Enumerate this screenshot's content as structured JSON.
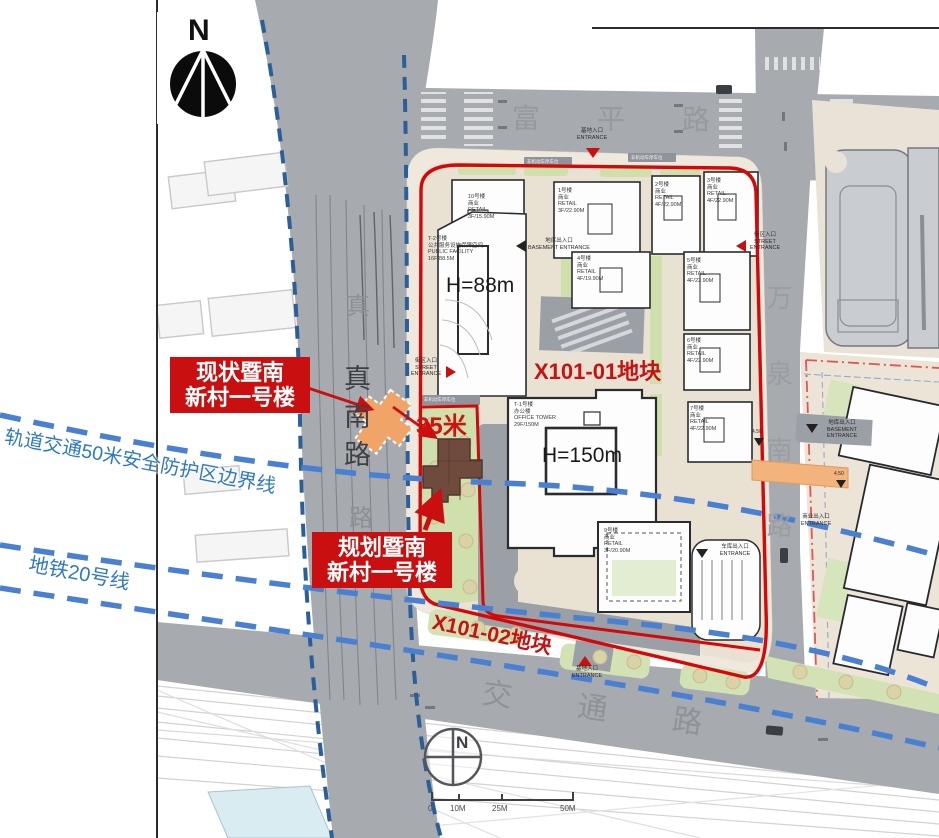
{
  "compass": {
    "north_label": "N",
    "south_compass_label": "N"
  },
  "roads": {
    "north": "富平路",
    "west": "真南路",
    "west_faint_top": "真",
    "west_faint_bottom": "路",
    "south": "交通路",
    "east": "万泉南路"
  },
  "parcels": {
    "p1": "X101-01地块",
    "p2": "X101-02地块"
  },
  "heights": {
    "west_tower": "H=88m",
    "center_tower": "H=150m"
  },
  "callouts": {
    "existing": {
      "line1": "现状暨南",
      "line2": "新村一号楼"
    },
    "planned": {
      "line1": "规划暨南",
      "line2": "新村一号楼"
    },
    "distance": "35米"
  },
  "transit": {
    "protection": "轨道交通50米安全防护区边界线",
    "metro": "地铁20号线"
  },
  "entrances": {
    "north_cn": "基地入口",
    "north_en": "ENTRANCE",
    "west_cn": "街区入口",
    "west_en": "STREET ENTRANCE",
    "east_cn": "街区入口",
    "east_en": "STREET ENTRANCE",
    "south_cn": "基地入口",
    "south_en": "ENTRANCE",
    "basement_cn": "地库出入口",
    "basement_en": "BASEMENT ENTRANCE",
    "garage_cn": "车库出入口",
    "garage_en": "ENTRANCE",
    "block2_cn": "地库出入口",
    "block2_en": "BASEMENT ENTRANCE",
    "retail_cn": "商业出入口",
    "retail_en": "ENTRANCE"
  },
  "buildings": {
    "t2": "T-2号楼\n公共服务设施保障空间\nPUBLIC FACILITY\n16F/88.5M",
    "b10": "10号楼\n商业\nRETAIL\n3F/15.90M",
    "b1": "1号楼\n商业\nRETAIL\n3F/22.90M",
    "b2": "2号楼\n商业\nRETAIL\n4F/22.90M",
    "b3": "3号楼\n商业\nRETAIL\n4F/22.90M",
    "b4": "4号楼\n商业\nRETAIL\n4F/19.90M",
    "b5": "5号楼\n商业\nRETAIL\n4F/22.90M",
    "b6": "6号楼\n商业\nRETAIL\n4F/22.90M",
    "b7": "7号楼\n商业\nRETAIL\n4F/22.90M",
    "t1": "T-1号楼\n办公楼\nOFFICE TOWER\n29F/150M",
    "b9": "9号楼\n商业\nRETAIL\n3F/20.90M",
    "parking": "非机动车停车位"
  },
  "elevations": {
    "e1": "4.50",
    "e2": "4.50"
  },
  "scalebar": {
    "t0": "0",
    "t1": "10M",
    "t2": "25M",
    "t3": "50M"
  },
  "colors": {
    "boundary_red": "#d40808",
    "callout_red": "#c90f0f",
    "metro_blue": "#4a80d2",
    "zone_blue": "#2b5f98",
    "label_blue": "#2e78c8",
    "existing_orange": "#f0a468",
    "planned_brown": "#6f4b3e"
  }
}
